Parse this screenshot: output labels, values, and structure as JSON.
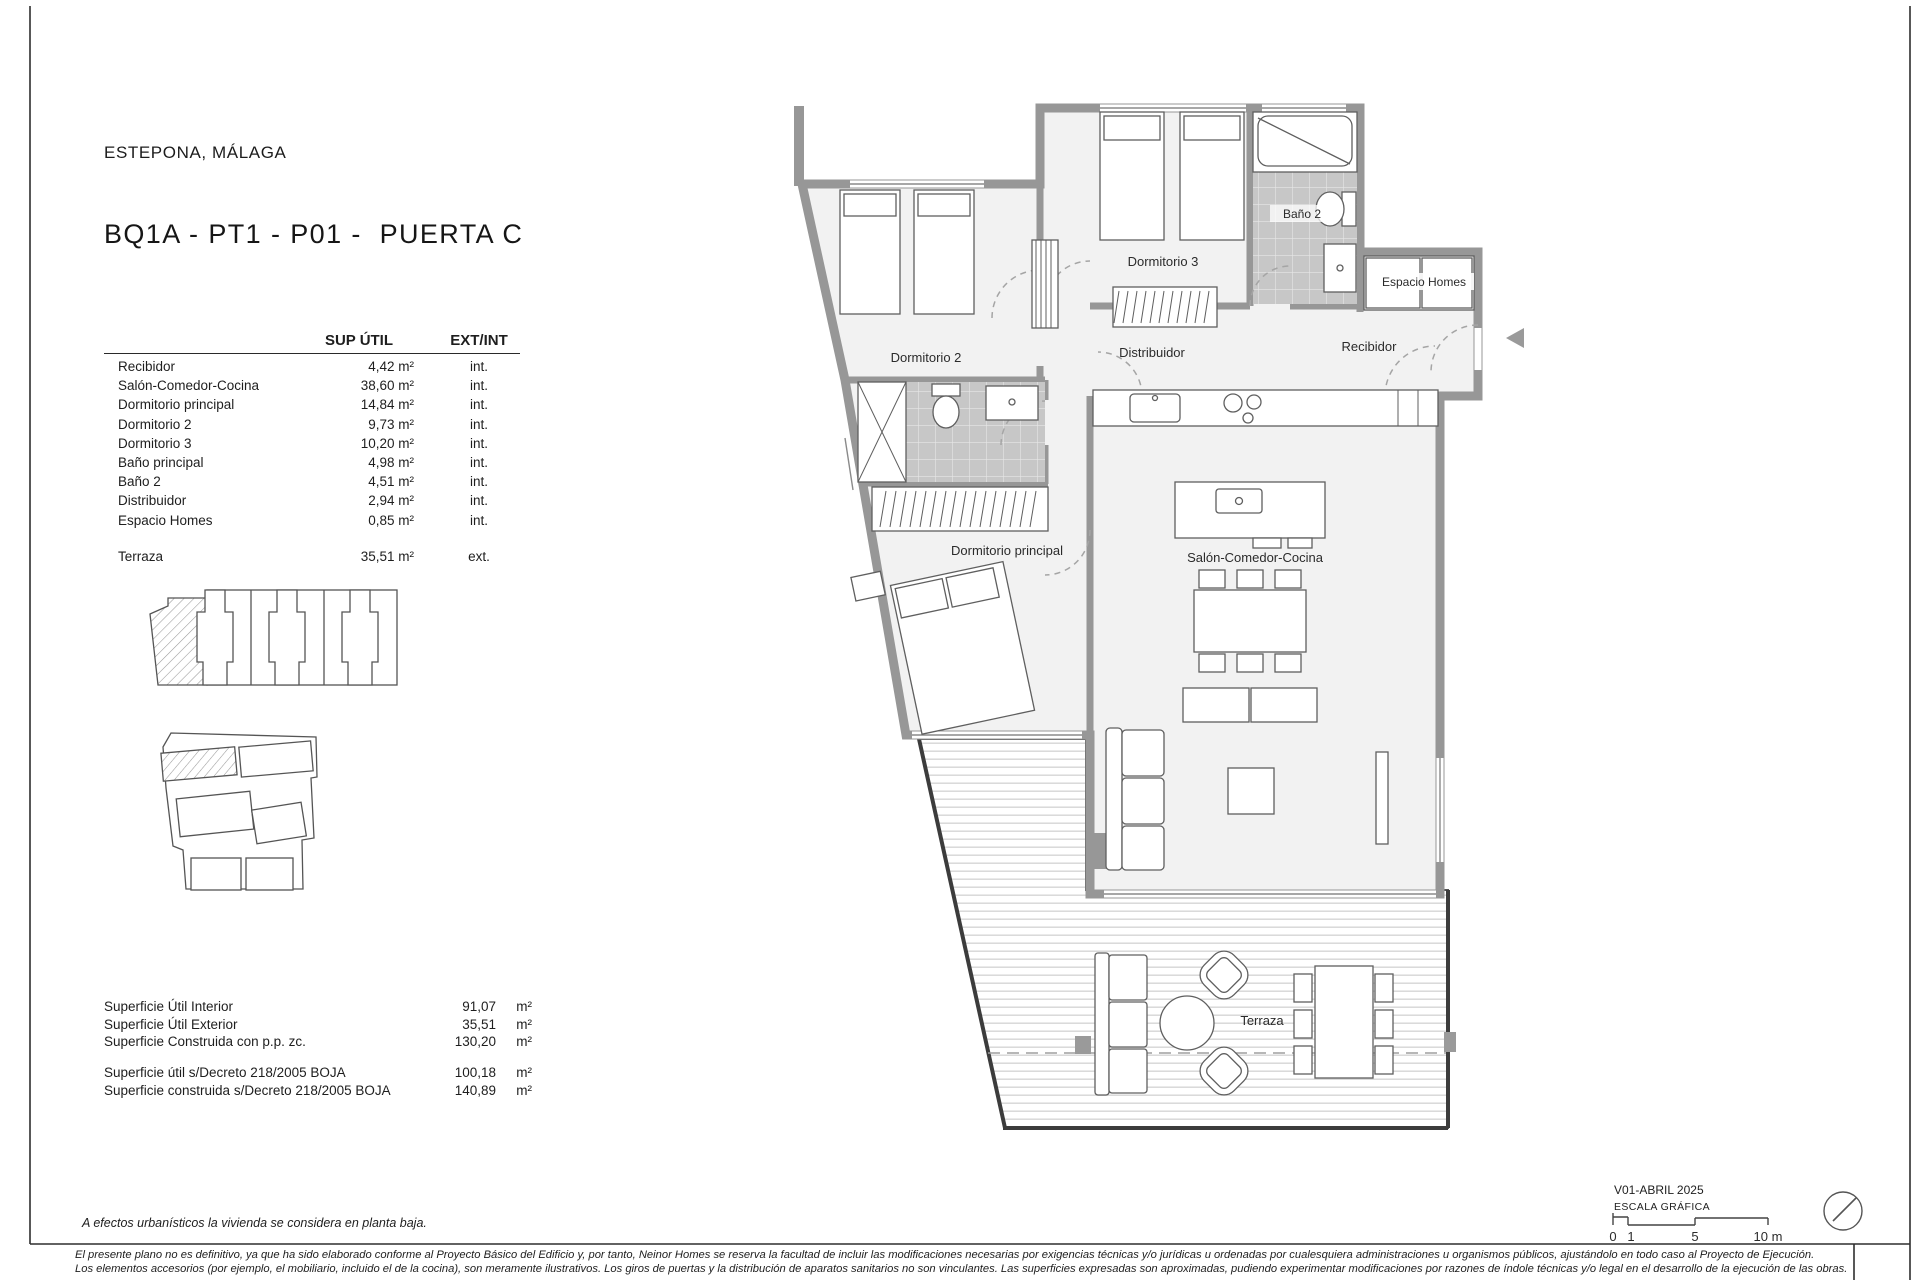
{
  "header": {
    "location": "ESTEPONA, MÁLAGA",
    "title": "BQ1A - PT1 - P01 -  PUERTA C"
  },
  "area_table": {
    "headers": {
      "sup": "SUP ÚTIL",
      "extint": "EXT/INT"
    },
    "rows": [
      {
        "label": "Recibidor",
        "sup": "4,42 m²",
        "type": "int."
      },
      {
        "label": "Salón-Comedor-Cocina",
        "sup": "38,60 m²",
        "type": "int."
      },
      {
        "label": "Dormitorio principal",
        "sup": "14,84 m²",
        "type": "int."
      },
      {
        "label": "Dormitorio 2",
        "sup": "9,73 m²",
        "type": "int."
      },
      {
        "label": "Dormitorio 3",
        "sup": "10,20 m²",
        "type": "int."
      },
      {
        "label": "Baño principal",
        "sup": "4,98 m²",
        "type": "int."
      },
      {
        "label": "Baño 2",
        "sup": "4,51 m²",
        "type": "int."
      },
      {
        "label": "Distribuidor",
        "sup": "2,94 m²",
        "type": "int."
      },
      {
        "label": "Espacio Homes",
        "sup": "0,85 m²",
        "type": "int."
      }
    ],
    "terraza": {
      "label": "Terraza",
      "sup": "35,51 m²",
      "type": "ext."
    }
  },
  "summary": {
    "block1": [
      {
        "label": "Superficie Útil Interior",
        "value": "91,07",
        "unit": "m²"
      },
      {
        "label": "Superficie Útil Exterior",
        "value": "35,51",
        "unit": "m²"
      },
      {
        "label": "Superficie Construida con p.p. zc.",
        "value": "130,20",
        "unit": "m²"
      }
    ],
    "block2": [
      {
        "label": "Superficie útil s/Decreto 218/2005 BOJA",
        "value": "100,18",
        "unit": "m²"
      },
      {
        "label": "Superficie construida s/Decreto 218/2005 BOJA",
        "value": "140,89",
        "unit": "m²"
      }
    ]
  },
  "plan": {
    "labels": {
      "dormitorio3": "Dormitorio 3",
      "dormitorio2": "Dormitorio 2",
      "bano2": "Baño 2",
      "espacio_homes": "Espacio Homes",
      "recibidor": "Recibidor",
      "distribuidor": "Distribuidor",
      "dormitorio_principal": "Dormitorio principal",
      "salon": "Salón-Comedor-Cocina",
      "terraza": "Terraza"
    }
  },
  "footer": {
    "note": "A efectos urbanísticos la vivienda se considera en planta baja.",
    "disclaimer1": "El presente plano no es definitivo, ya que ha sido elaborado conforme al Proyecto Básico del Edificio y, por tanto, Neinor Homes se reserva la facultad de incluir las modificaciones necesarias por exigencias técnicas y/o jurídicas u ordenadas por cualesquiera administraciones u organismos públicos, ajustándolo en todo caso al Proyecto de Ejecución.",
    "disclaimer2": "Los elementos accesorios (por ejemplo, el mobiliario, incluido el de la cocina), son meramente ilustrativos. Los giros de puertas y la distribución de aparatos sanitarios no son vinculantes. Las superficies expresadas son aproximadas, pudiendo experimentar modificaciones por razones de índole técnicas y/o legal en el desarrollo de la ejecución de las obras.",
    "version": "V01-ABRIL 2025",
    "scale_label": "ESCALA GRÁFICA",
    "ticks": {
      "t0": "0",
      "t1": "1",
      "t5": "5",
      "t10": "10 m"
    }
  }
}
